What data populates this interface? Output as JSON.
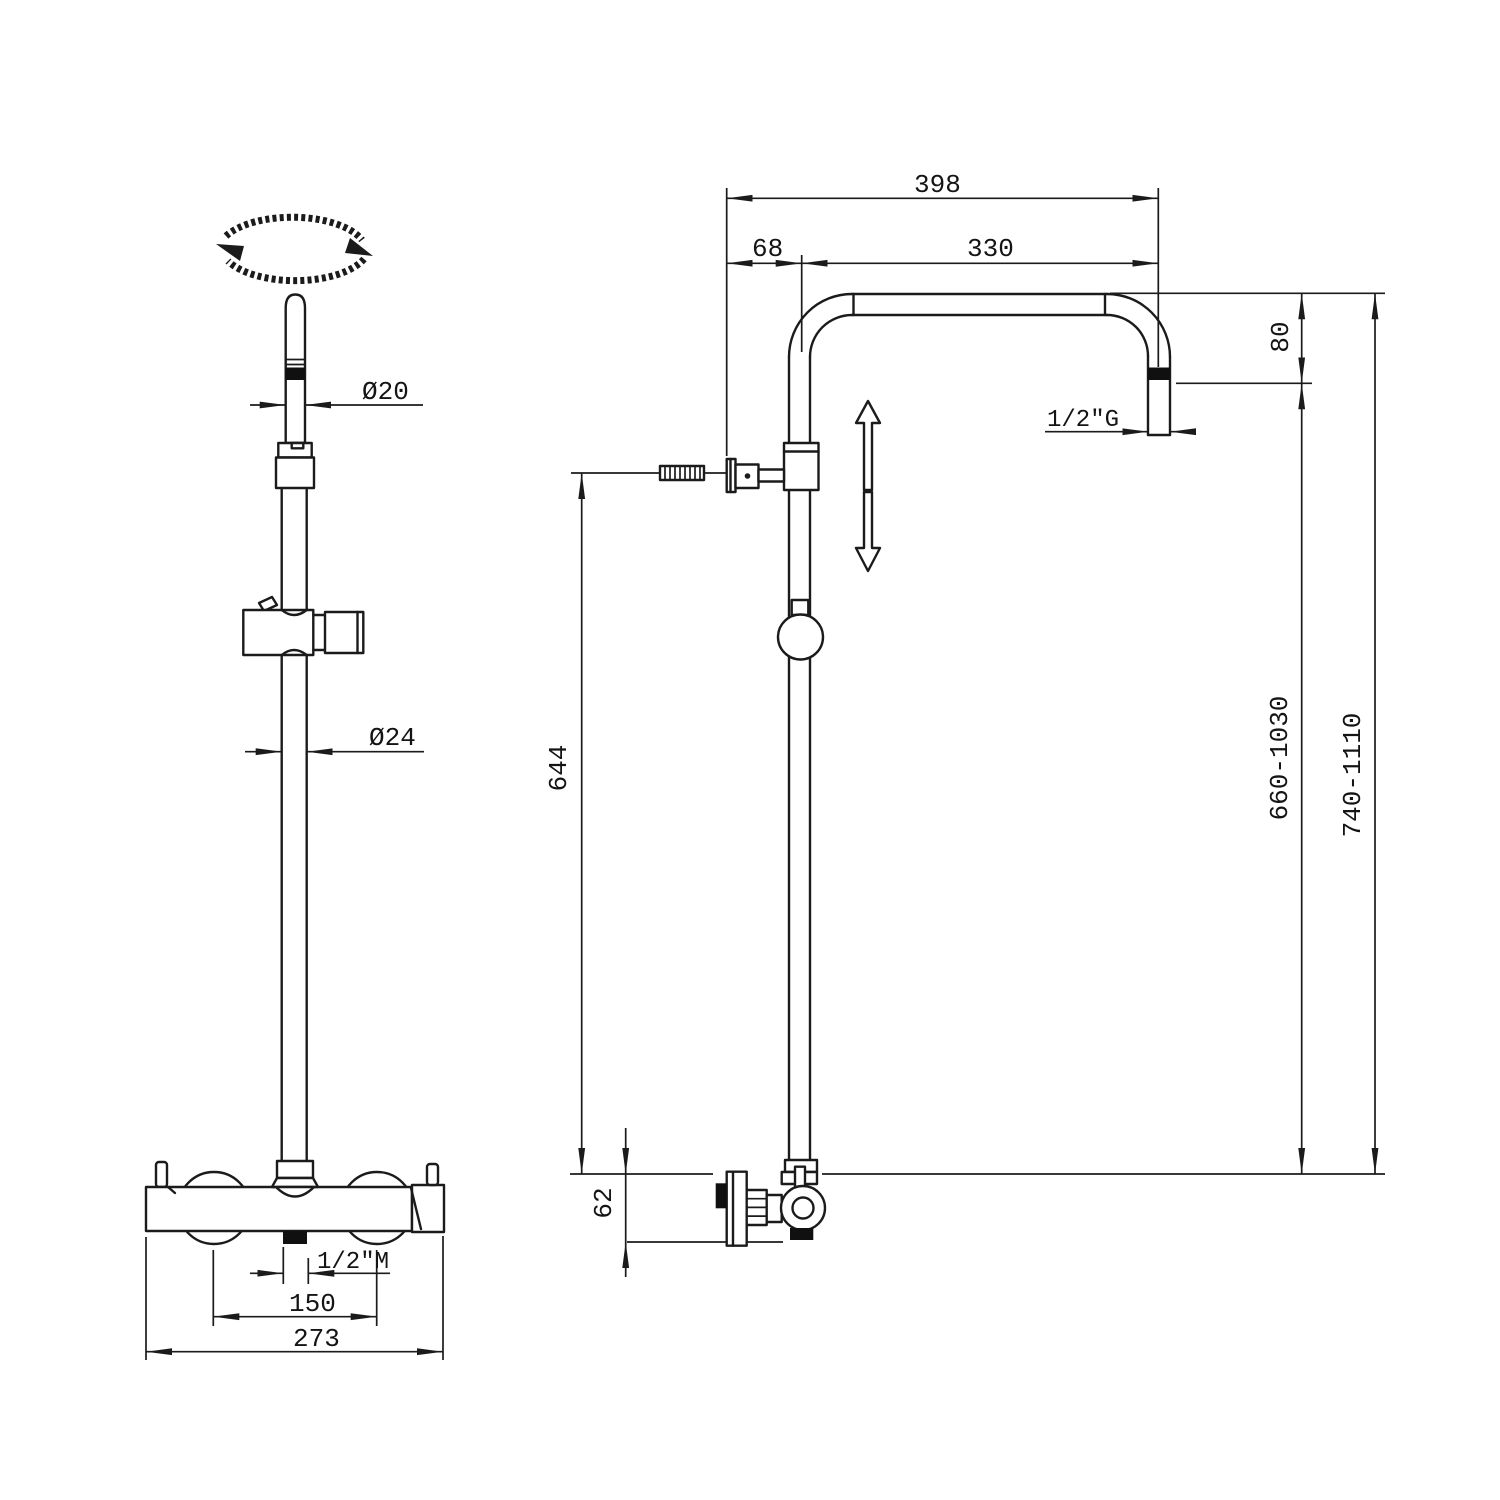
{
  "drawing": {
    "kind": "shower column technical dimension drawing",
    "views": {
      "front": "front view with hand shower rail and thermostatic valve",
      "side": "side view with overhead arm, wall bracket and valve"
    }
  },
  "colors": {
    "line": "#1b1b1b",
    "background": "#ffffff"
  },
  "labels": {
    "dia_handle": "Ø20",
    "dia_rail": "Ø24",
    "thread_inlet": "1/2\"M",
    "spacing_inlets": "150",
    "width_valve": "273",
    "width_overall": "398",
    "width_arm": "330",
    "offset_column": "68",
    "drop_head": "80",
    "thread_outlet": "1/2\"G",
    "height_column": "644",
    "height_valve_offset": "62",
    "range_column": "660-1030",
    "range_overall": "740-1110"
  }
}
